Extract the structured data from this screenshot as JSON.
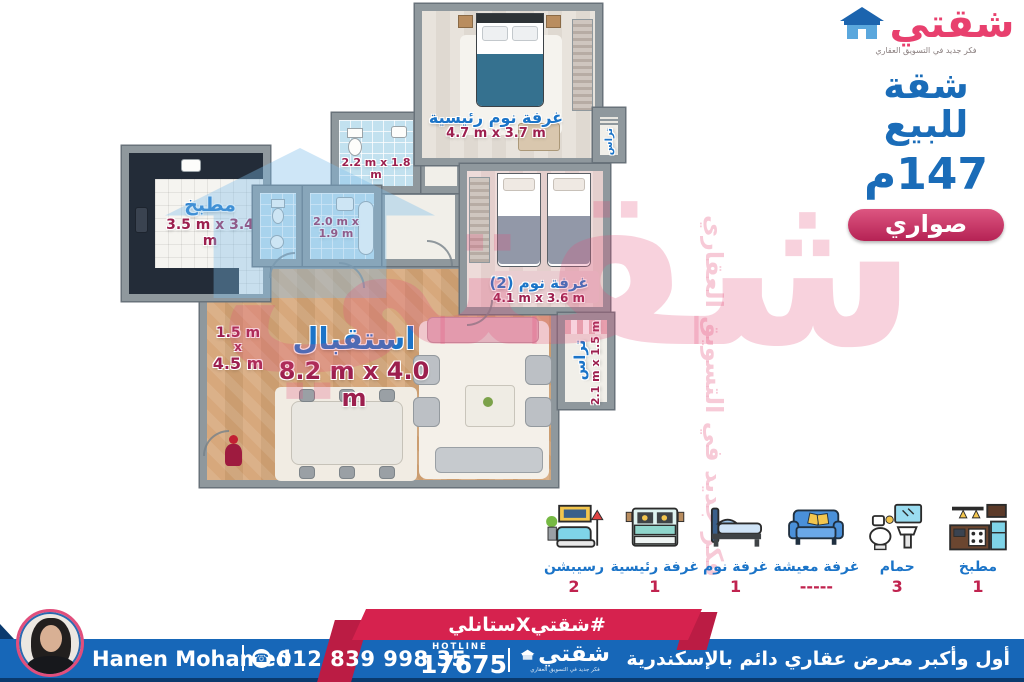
{
  "header": {
    "logo_text": "شقتي",
    "logo_tagline": "فكر جديد في التسويق العقاري",
    "listing_title": "شقة للبيع",
    "area_label": "147م",
    "location_badge": "صواري"
  },
  "colors": {
    "brand_blue": "#1a6cb8",
    "brand_pink": "#e8406e",
    "ribbon_crimson": "#d6224e",
    "footer_blue": "#1767b8",
    "dims_red": "#9c1f4e",
    "wall_gray": "#8f989d"
  },
  "floor_plan": {
    "watermark_text": "شقتي",
    "watermark_tagline": "فكر جديد في التسويق العقاري",
    "kitchen": {
      "name": "مطبخ",
      "dims": "3.5 m x 3.4 m"
    },
    "master_bedroom": {
      "name": "غرفة نوم رئيسية",
      "dims": "4.7 m x 3.7 m"
    },
    "bathroom_1": {
      "dims": "2.2 m x 1.8 m"
    },
    "bathroom_2": {
      "dims": "2.0 m x 1.9 m"
    },
    "bedroom_2": {
      "name": "غرفة نوم (2)",
      "dims": "4.1 m x 3.6 m"
    },
    "reception": {
      "name": "استقبال",
      "dims": "8.2 m x 4.0 m"
    },
    "hallway": {
      "width": "1.5 m",
      "sep": "x",
      "length": "4.5 m"
    },
    "terrace": {
      "name": "تراس",
      "dims": "2.1 m x 1.5 m"
    },
    "shaft": {
      "name": "تراس"
    }
  },
  "legend": {
    "items": [
      {
        "label": "رسيبشن",
        "count": "2"
      },
      {
        "label": "غرفة رئيسية",
        "count": "1"
      },
      {
        "label": "غرفة نوم",
        "count": "1"
      },
      {
        "label": "غرفة معيشة",
        "count": "-----"
      },
      {
        "label": "حمام",
        "count": "3"
      },
      {
        "label": "مطبخ",
        "count": "1"
      }
    ]
  },
  "footer": {
    "hashtag": "#شقتيXستانلي",
    "agent_name": "Hanen Mohamed",
    "phone": "012 839 998 35",
    "hotline_label": "HOTLINE",
    "hotline_number": "17675",
    "logo_text": "شقتي",
    "logo_tagline": "فكر جديد في التسويق العقاري",
    "slogan": "أول وأكبر معرض عقاري دائم بالإسكندرية"
  }
}
